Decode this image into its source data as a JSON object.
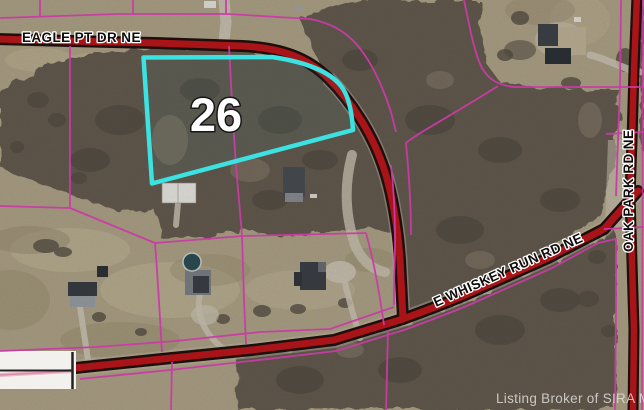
{
  "map": {
    "parcel_label": "26",
    "roads": {
      "eagle": "EAGLE PT DR NE",
      "whiskey": "E WHISKEY RUN RD NE",
      "oak_park": "OAK PARK RD NE"
    },
    "watermark": "Listing Broker of SIRA MLS©",
    "colors": {
      "highlight_cyan": "#3ce2e2",
      "parcel_line_magenta": "#cb3ba6",
      "road_red": "#a81418",
      "road_casing": "#1c0f0c",
      "field_tan": "#b1a589",
      "woods": "#665d51"
    }
  }
}
